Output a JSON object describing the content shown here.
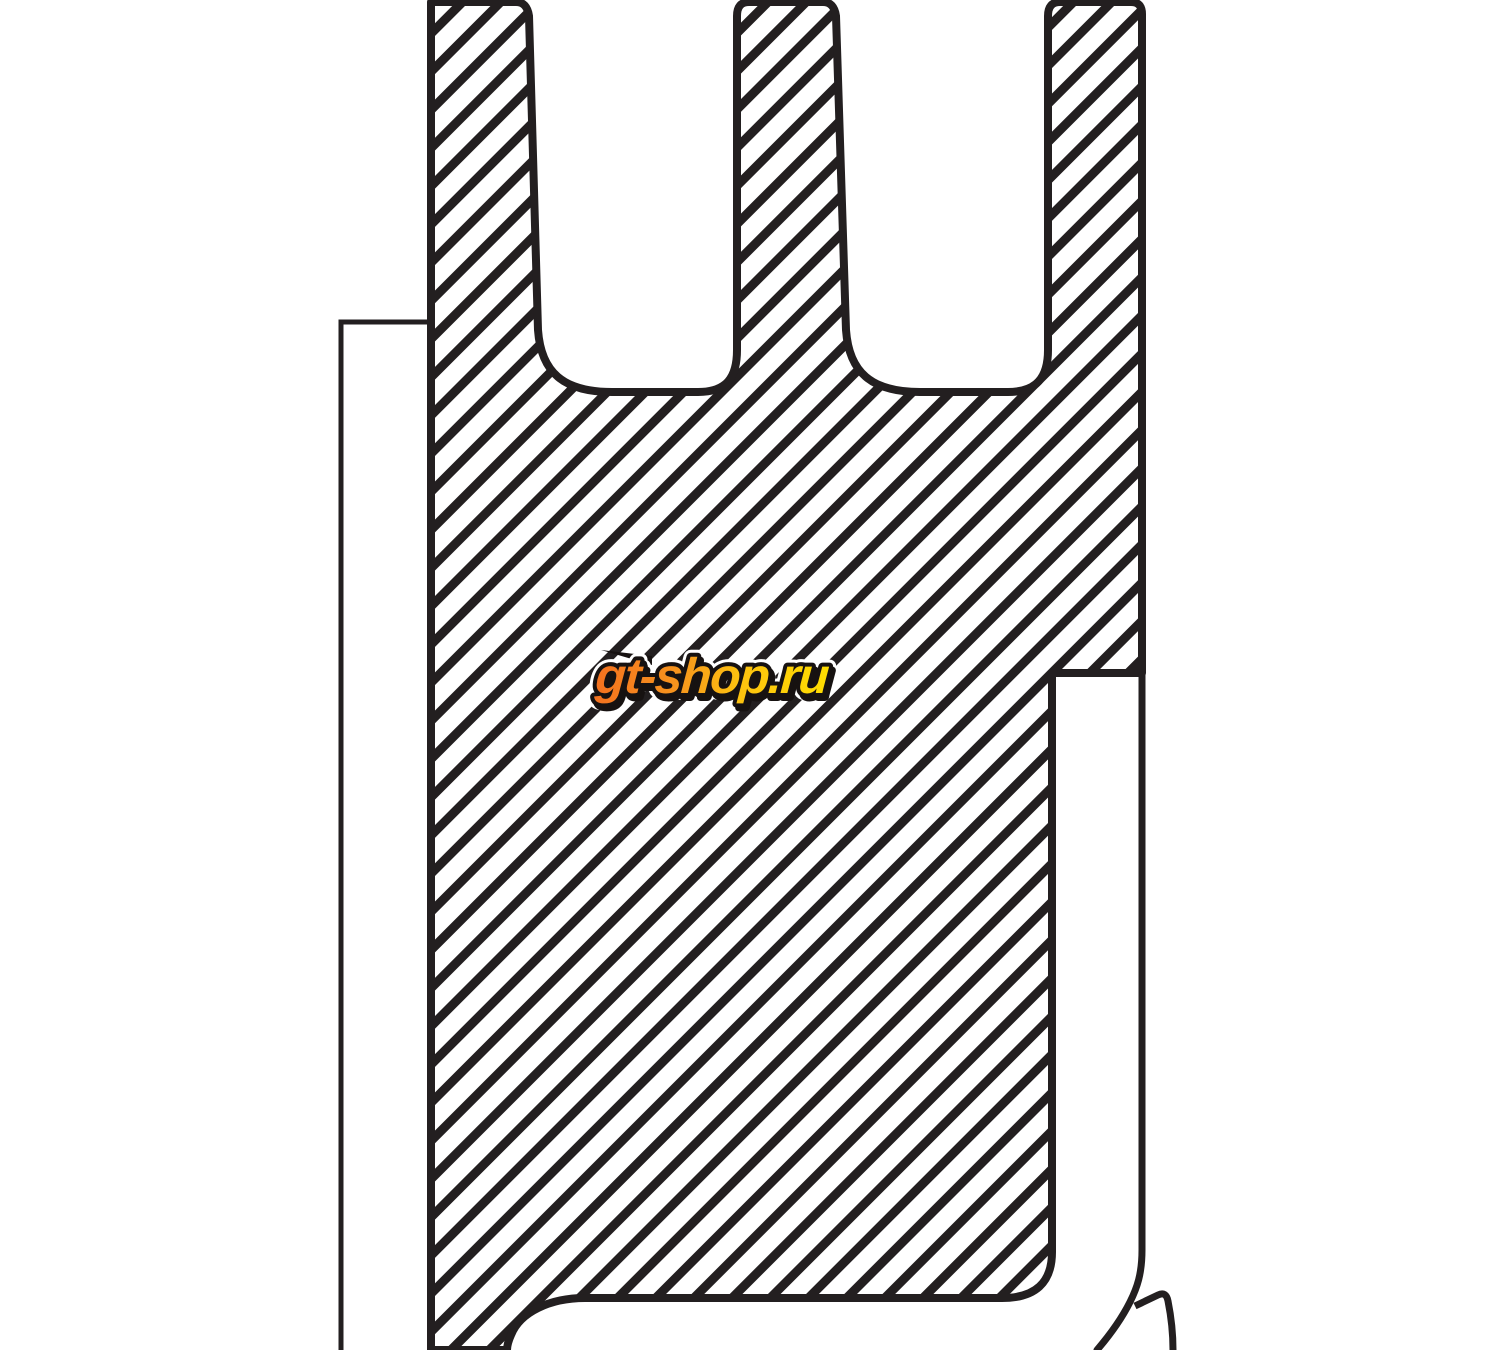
{
  "page": {
    "width_px": 1500,
    "height_px": 1350,
    "background": "#ffffff"
  },
  "diagram": {
    "kind": "technical cross-section drawing",
    "description": "Black-and-white catalog drawing of a shaft seal profile in cross-section: hatched main body with three ribs at the top separated by two U-shaped grooves, a thin backing ring outline on the left, a stepped outer edge with a narrow white channel on the right, and a sealing lip at the bottom right; drawing is cropped at the top and bottom edges.",
    "outline_color": "#231f20",
    "background": "#ffffff",
    "hatch": {
      "style": "diagonal section hatching, 45 degrees rising to the right",
      "line_color": "#231f20",
      "perpendicular_spacing_px": 27,
      "line_width_px": 9
    },
    "parts": [
      {
        "name": "main-body",
        "fill": "hatched"
      },
      {
        "name": "backing-ring",
        "fill": "white"
      },
      {
        "name": "right-channel",
        "fill": "white"
      },
      {
        "name": "bottom-lip-flap",
        "fill": "white"
      }
    ]
  },
  "watermark": {
    "text": "gt-shop.ru",
    "fill_gradient": [
      "#f4711f",
      "#f7941d",
      "#fdc20f",
      "#ffdd00"
    ],
    "outline_color": "#171211",
    "halo_color": "#ffffff",
    "accent_color": "#f58220"
  }
}
